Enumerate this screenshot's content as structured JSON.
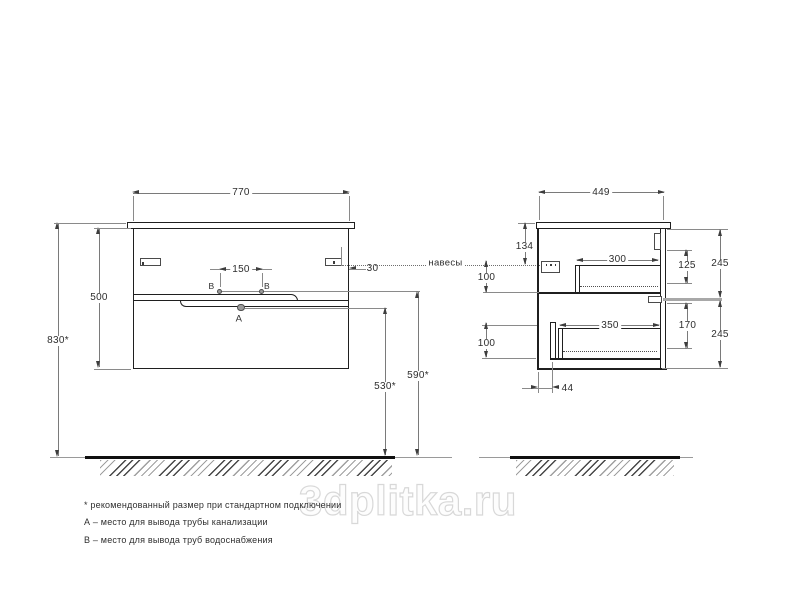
{
  "watermark": "3dplitka.ru",
  "front_view": {
    "width": "770",
    "body_height": "500",
    "total_height": "830*",
    "outlet_spacing": "150",
    "hanger_offset": "30",
    "label_b": "В",
    "label_a": "А",
    "supply_height": "590*",
    "drain_height": "530*"
  },
  "side_view": {
    "depth": "449",
    "hanger_top_offset": "134",
    "hanger_gap": "100",
    "upper_drawer_depth": "300",
    "upper_drawer_inner_height": "125",
    "upper_section_height": "245",
    "lower_drawer_depth": "350",
    "lower_drawer_inner_height": "170",
    "lower_section_height": "245",
    "lower_gap": "100",
    "front_clearance": "44"
  },
  "callouts": {
    "hangers": "навесы"
  },
  "notes": {
    "recommended": "* рекомендованный размер при стандартном подключении",
    "a": "А – место для вывода трубы канализации",
    "b": "В – место для вывода труб водоснабжения"
  },
  "colors": {
    "line_dark": "#1f1f1f",
    "line_dim": "#7a7a7a",
    "watermark_outline": "#d8d8d8"
  }
}
